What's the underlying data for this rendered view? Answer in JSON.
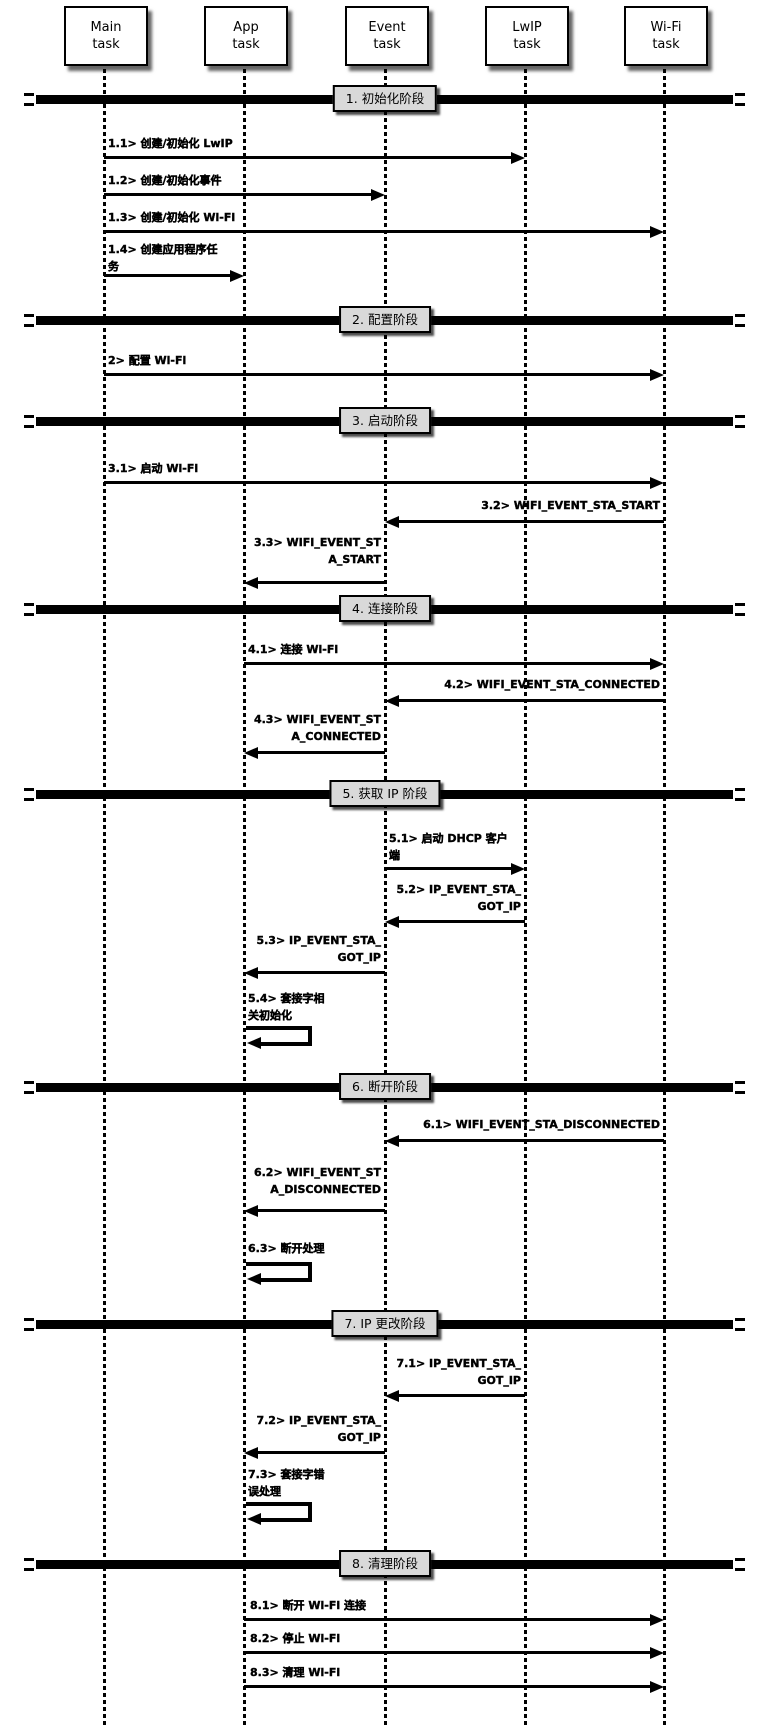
{
  "colors": {
    "line": "#000000",
    "phase_box_fill": "#d9d9d9",
    "task_box_fill": "#ffffff",
    "text": "#000000"
  },
  "diagram": {
    "tasks": [
      {
        "name": "main-task",
        "lines": [
          "Main",
          "task"
        ]
      },
      {
        "name": "app-task",
        "lines": [
          "App",
          "task"
        ]
      },
      {
        "name": "event-task",
        "lines": [
          "Event",
          "task"
        ]
      },
      {
        "name": "lwip-task",
        "lines": [
          "LwIP",
          "task"
        ]
      },
      {
        "name": "wifi-task",
        "lines": [
          "Wi-Fi",
          "task"
        ]
      }
    ],
    "phases": [
      {
        "label": "1. 初始化阶段"
      },
      {
        "label": "2. 配置阶段"
      },
      {
        "label": "3. 启动阶段"
      },
      {
        "label": "4. 连接阶段"
      },
      {
        "label": "5. 获取 IP 阶段"
      },
      {
        "label": "6. 断开阶段"
      },
      {
        "label": "7. IP 更改阶段"
      },
      {
        "label": "8. 清理阶段"
      }
    ],
    "messages": [
      {
        "id": "1.1",
        "type": "message",
        "from": "Main task",
        "to": "LwIP task",
        "lines": [
          "1.1> 创建/初始化 LwIP"
        ]
      },
      {
        "id": "1.2",
        "type": "message",
        "from": "Main task",
        "to": "Event task",
        "lines": [
          "1.2> 创建/初始化事件"
        ]
      },
      {
        "id": "1.3",
        "type": "message",
        "from": "Main task",
        "to": "Wi-Fi task",
        "lines": [
          "1.3> 创建/初始化 Wi-Fi"
        ]
      },
      {
        "id": "1.4",
        "type": "message",
        "from": "Main task",
        "to": "App task",
        "lines": [
          "1.4> 创建应用程序任",
          "务"
        ]
      },
      {
        "id": "2",
        "type": "message",
        "from": "Main task",
        "to": "Wi-Fi task",
        "lines": [
          "2> 配置 Wi-Fi"
        ]
      },
      {
        "id": "3.1",
        "type": "message",
        "from": "Main task",
        "to": "Wi-Fi task",
        "lines": [
          "3.1> 启动 Wi-Fi"
        ]
      },
      {
        "id": "3.2",
        "type": "message",
        "from": "Wi-Fi task",
        "to": "Event task",
        "lines": [
          "3.2> WIFI_EVENT_STA_START"
        ]
      },
      {
        "id": "3.3",
        "type": "message",
        "from": "Event task",
        "to": "App task",
        "lines": [
          "3.3> WIFI_EVENT_ST",
          "A_START"
        ]
      },
      {
        "id": "4.1",
        "type": "message",
        "from": "App task",
        "to": "Wi-Fi task",
        "lines": [
          "4.1> 连接 Wi-Fi"
        ]
      },
      {
        "id": "4.2",
        "type": "message",
        "from": "Wi-Fi task",
        "to": "Event task",
        "lines": [
          "4.2> WIFI_EVENT_STA_CONNECTED"
        ]
      },
      {
        "id": "4.3",
        "type": "message",
        "from": "Event task",
        "to": "App task",
        "lines": [
          "4.3> WIFI_EVENT_ST",
          "A_CONNECTED"
        ]
      },
      {
        "id": "5.1",
        "type": "message",
        "from": "Event task",
        "to": "LwIP task",
        "lines": [
          "5.1> 启动 DHCP 客户",
          "端"
        ]
      },
      {
        "id": "5.2",
        "type": "message",
        "from": "LwIP task",
        "to": "Event task",
        "lines": [
          "5.2> IP_EVENT_STA_",
          "GOT_IP"
        ]
      },
      {
        "id": "5.3",
        "type": "message",
        "from": "Event task",
        "to": "App task",
        "lines": [
          "5.3> IP_EVENT_STA_",
          "GOT_IP"
        ]
      },
      {
        "id": "5.4",
        "type": "self",
        "from": "App task",
        "to": "App task",
        "lines": [
          "5.4> 套接字相",
          "关初始化"
        ]
      },
      {
        "id": "6.1",
        "type": "message",
        "from": "Wi-Fi task",
        "to": "Event task",
        "lines": [
          "6.1> WIFI_EVENT_STA_DISCONNECTED"
        ]
      },
      {
        "id": "6.2",
        "type": "message",
        "from": "Event task",
        "to": "App task",
        "lines": [
          "6.2> WIFI_EVENT_ST",
          "A_DISCONNECTED"
        ]
      },
      {
        "id": "6.3",
        "type": "self",
        "from": "App task",
        "to": "App task",
        "lines": [
          "6.3> 断开处理"
        ]
      },
      {
        "id": "7.1",
        "type": "message",
        "from": "LwIP task",
        "to": "Event task",
        "lines": [
          "7.1> IP_EVENT_STA_",
          "GOT_IP"
        ]
      },
      {
        "id": "7.2",
        "type": "message",
        "from": "Event task",
        "to": "App task",
        "lines": [
          "7.2> IP_EVENT_STA_",
          "GOT_IP"
        ]
      },
      {
        "id": "7.3",
        "type": "self",
        "from": "App task",
        "to": "App task",
        "lines": [
          "7.3> 套接字错",
          "误处理"
        ]
      },
      {
        "id": "8.1",
        "type": "message",
        "from": "App task",
        "to": "Wi-Fi task",
        "lines": [
          "8.1> 断开 Wi-Fi 连接"
        ]
      },
      {
        "id": "8.2",
        "type": "message",
        "from": "App task",
        "to": "Wi-Fi task",
        "lines": [
          "8.2> 停止 Wi-Fi"
        ]
      },
      {
        "id": "8.3",
        "type": "message",
        "from": "App task",
        "to": "Wi-Fi task",
        "lines": [
          "8.3> 清理 Wi-Fi"
        ]
      }
    ]
  }
}
